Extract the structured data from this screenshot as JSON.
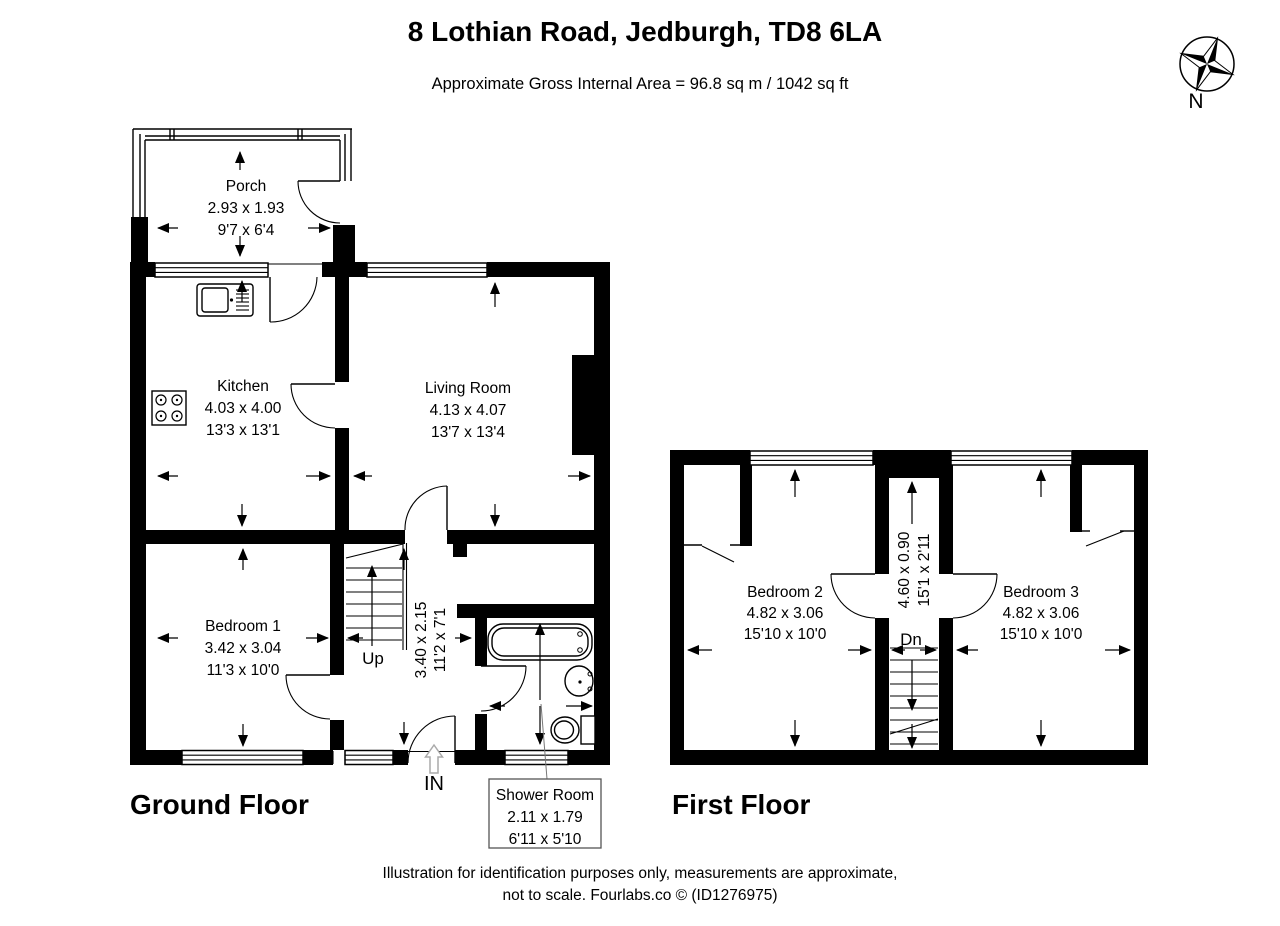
{
  "header": {
    "title": "8 Lothian Road, Jedburgh, TD8 6LA",
    "subtitle": "Approximate Gross Internal Area = 96.8 sq m / 1042 sq ft"
  },
  "compass": {
    "north_label": "N"
  },
  "ground_floor": {
    "label": "Ground Floor",
    "entrance_label": "IN",
    "stairs_label": "Up",
    "rooms": {
      "porch": {
        "name": "Porch",
        "metric": "2.93 x 1.93",
        "imperial": "9'7 x 6'4"
      },
      "kitchen": {
        "name": "Kitchen",
        "metric": "4.03 x 4.00",
        "imperial": "13'3 x 13'1"
      },
      "living_room": {
        "name": "Living Room",
        "metric": "4.13 x 4.07",
        "imperial": "13'7 x 13'4"
      },
      "bedroom_1": {
        "name": "Bedroom 1",
        "metric": "3.42 x 3.04",
        "imperial": "11'3 x 10'0"
      },
      "hall": {
        "metric": "3.40 x 2.15",
        "imperial": "11'2 x 7'1"
      },
      "shower_room": {
        "name": "Shower Room",
        "metric": "2.11 x 1.79",
        "imperial": "6'11 x 5'10"
      }
    }
  },
  "first_floor": {
    "label": "First Floor",
    "stairs_label": "Dn",
    "rooms": {
      "bedroom_2": {
        "name": "Bedroom 2",
        "metric": "4.82 x 3.06",
        "imperial": "15'10 x 10'0"
      },
      "bedroom_3": {
        "name": "Bedroom 3",
        "metric": "4.82 x 3.06",
        "imperial": "15'10 x 10'0"
      },
      "landing": {
        "metric": "4.60 x 0.90",
        "imperial": "15'1 x 2'11"
      }
    }
  },
  "footer": {
    "line1": "Illustration for identification purposes only, measurements are approximate,",
    "line2": "not to scale. Fourlabs.co © (ID1276975)"
  }
}
